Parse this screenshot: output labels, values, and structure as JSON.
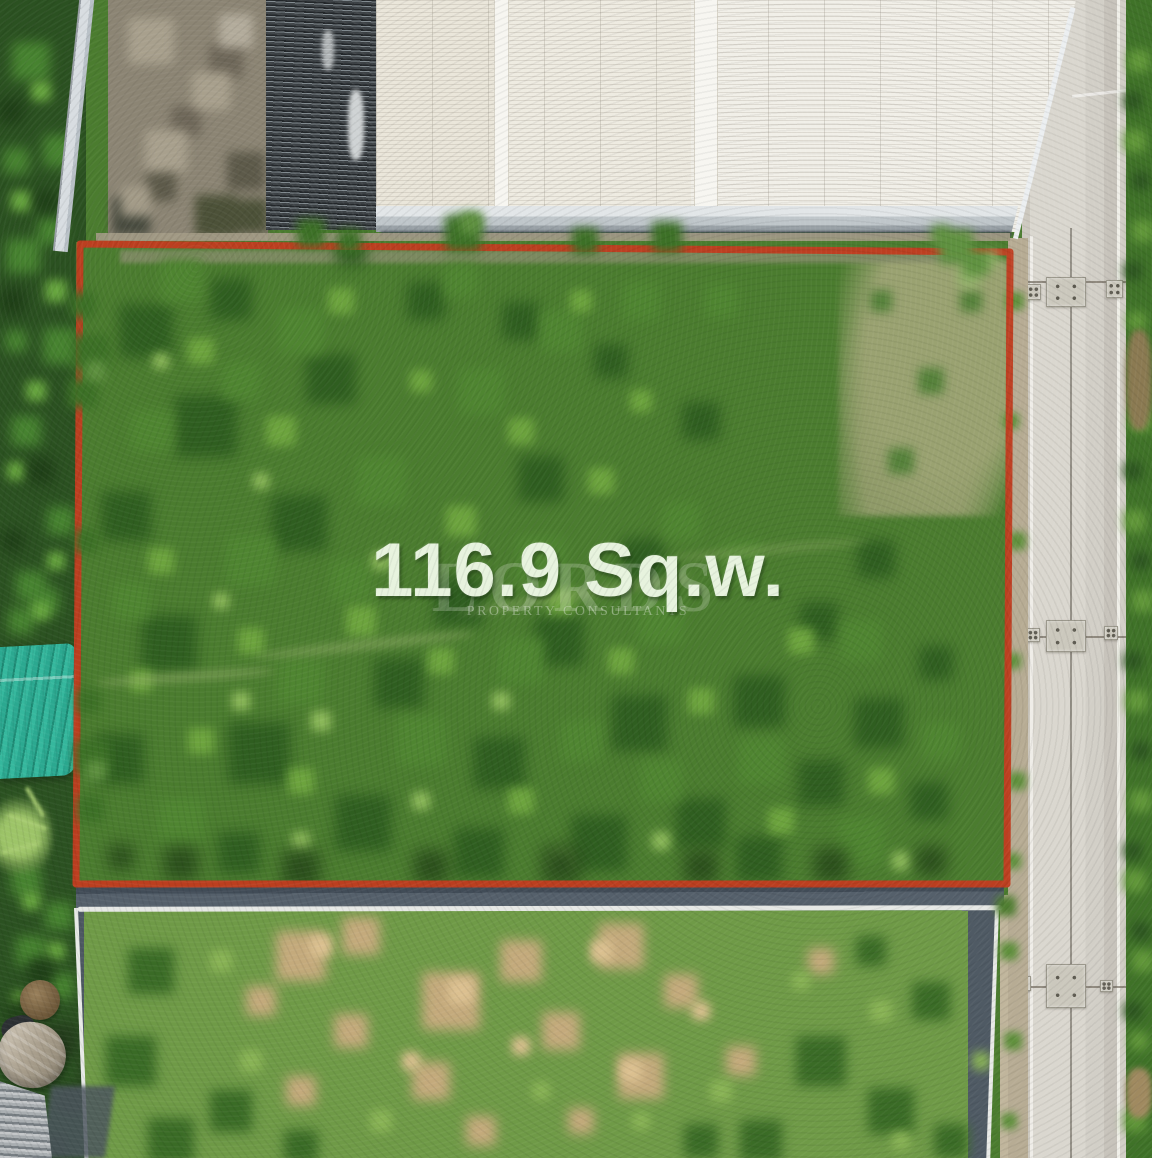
{
  "overlay": {
    "area_label": "116.9 Sq.w."
  },
  "watermark": {
    "brand": "LORDS",
    "tagline": "PROPERTY CONSULTANTS"
  },
  "colors": {
    "boundary_red": "#c13c1f",
    "area_text": "#e7f3de",
    "plot_green": "#4b7c2f",
    "road_concrete": "#d8d5cd",
    "roof_white": "#efece3",
    "roof_dark_gray": "#3c4145",
    "teal_roof": "#2aa88f",
    "lower_wall_gray": "#4f5a66",
    "watermark_white": "#fafcf8"
  }
}
